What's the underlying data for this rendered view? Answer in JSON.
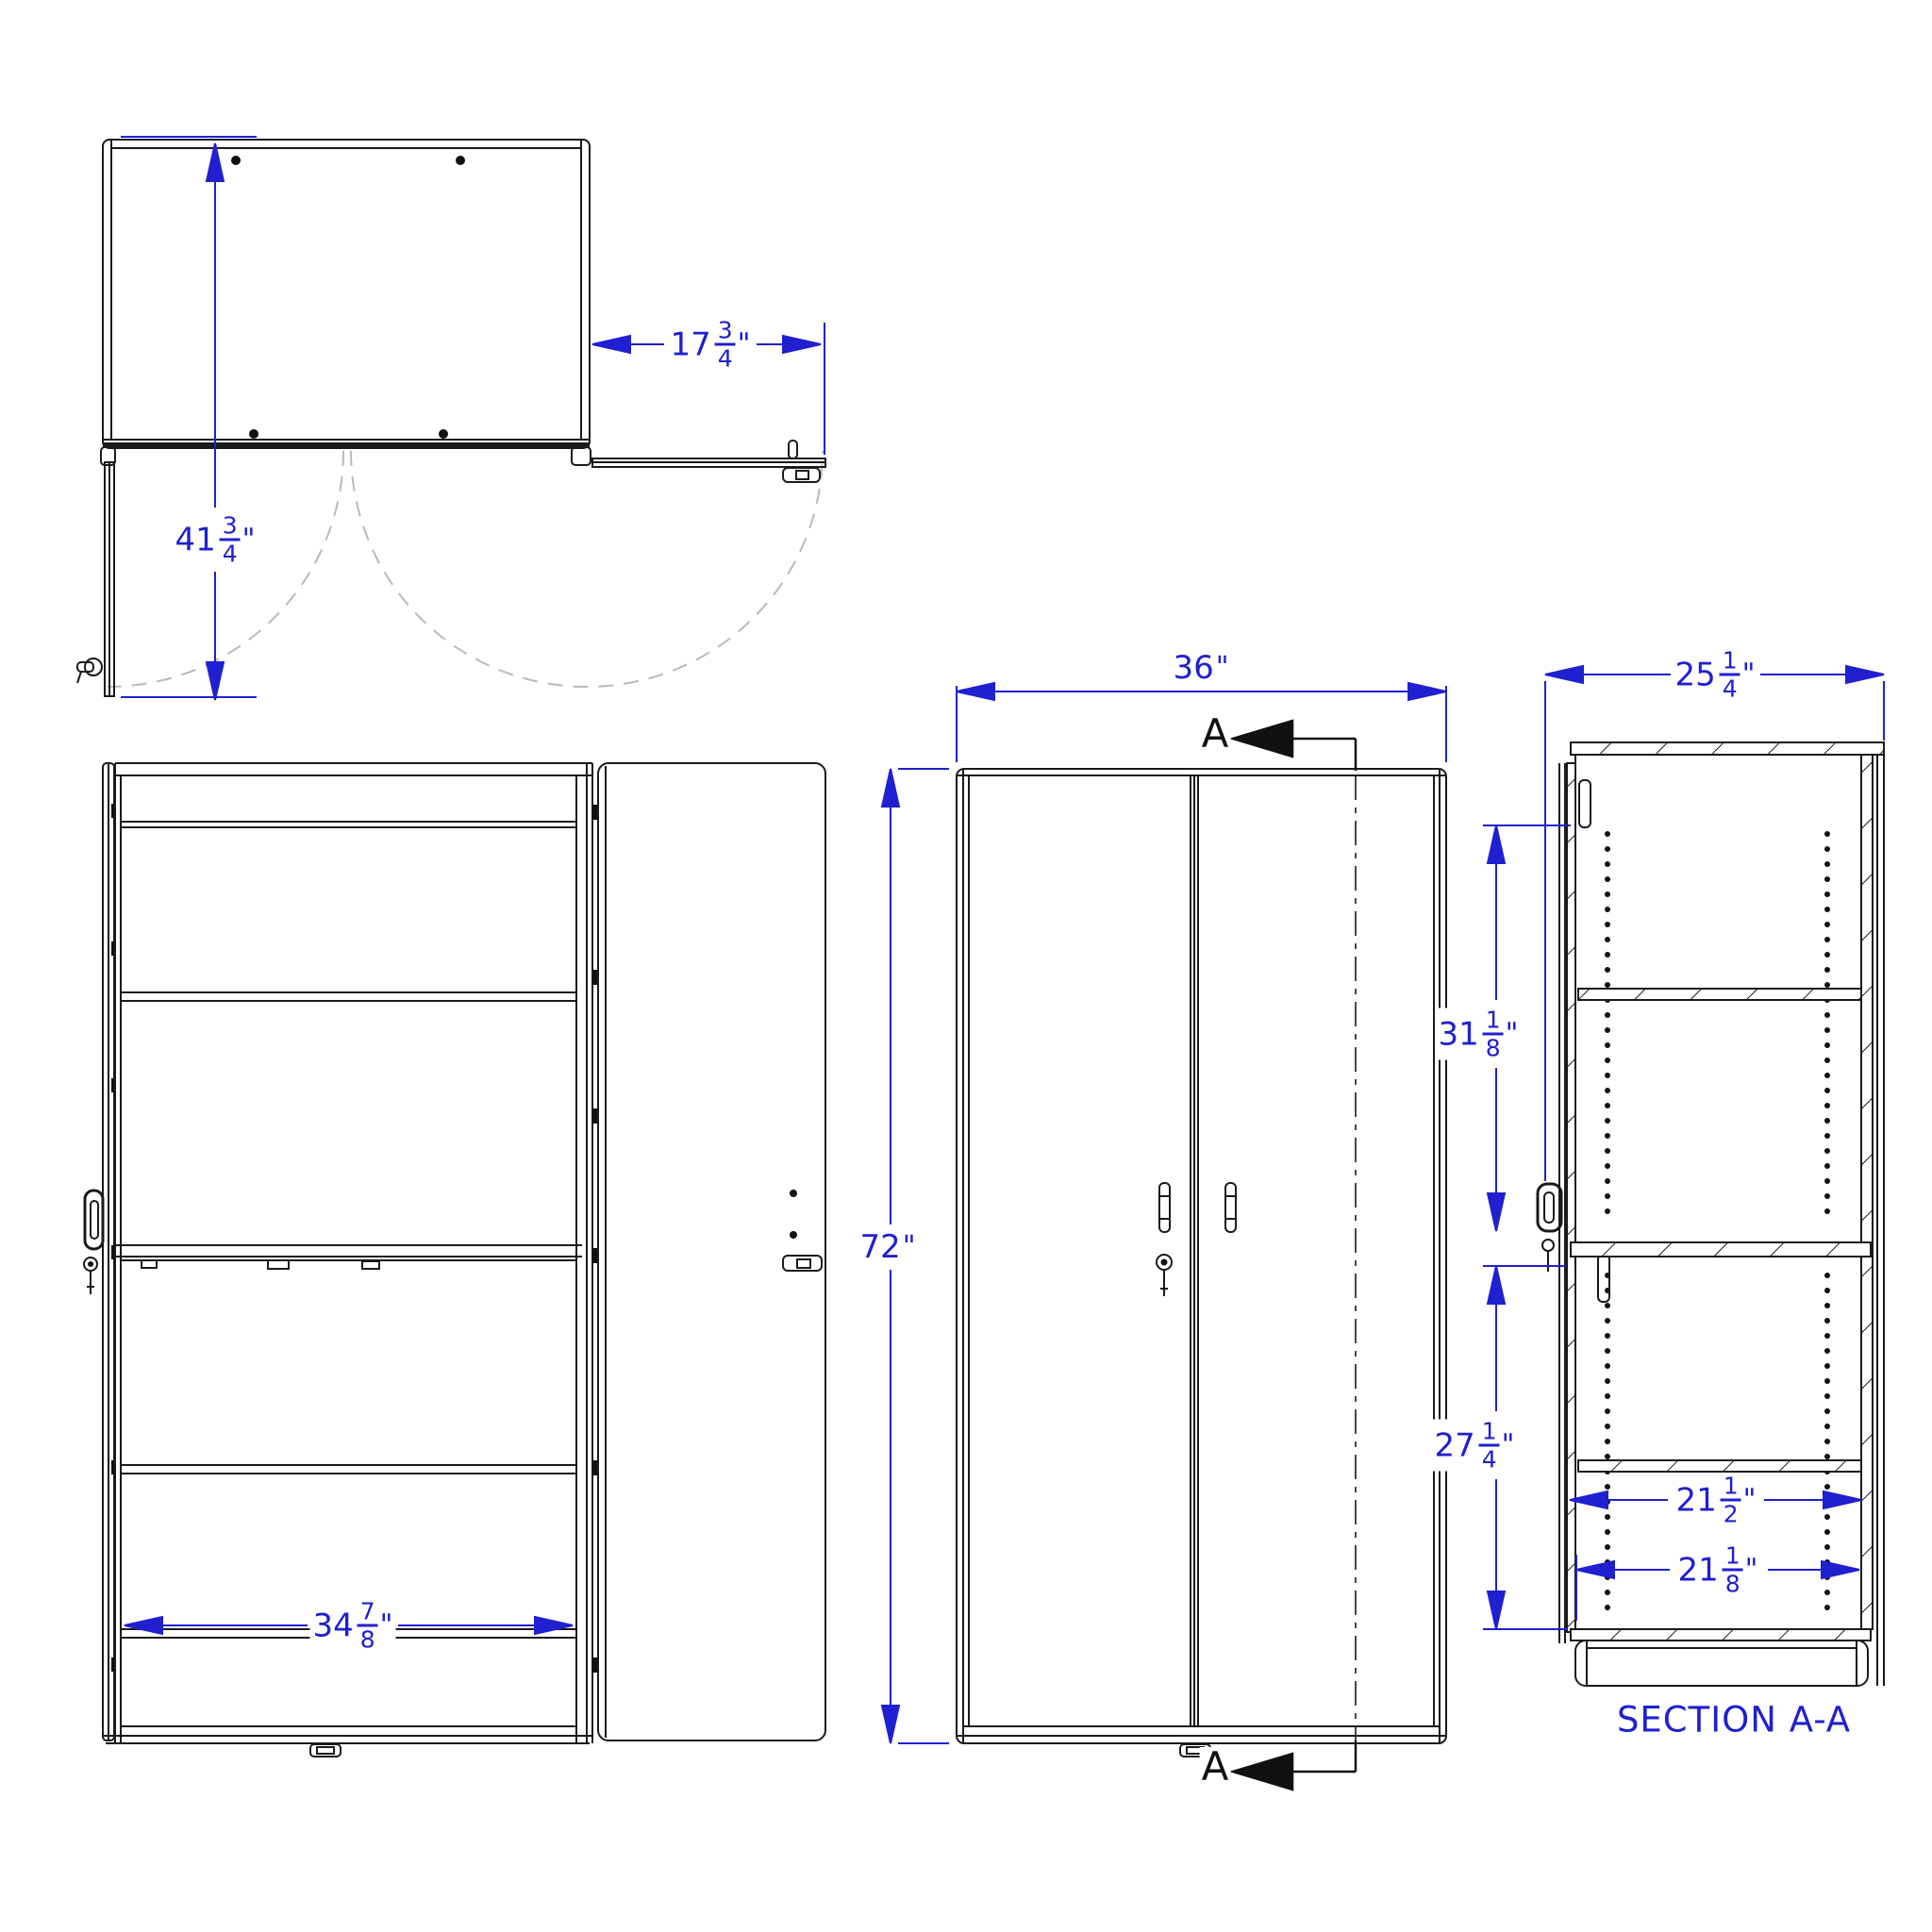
{
  "drawing": {
    "section_title": "SECTION A-A",
    "section_marker": {
      "top": "A",
      "bottom": "A"
    }
  },
  "dimensions": {
    "door_width": {
      "whole": "17",
      "num": "3",
      "den": "4",
      "unit": "\""
    },
    "open_door_depth": {
      "whole": "41",
      "num": "3",
      "den": "4",
      "unit": "\""
    },
    "interior_width": {
      "whole": "34",
      "num": "7",
      "den": "8",
      "unit": "\""
    },
    "overall_width": {
      "whole": "36",
      "unit": "\""
    },
    "overall_height": {
      "whole": "72",
      "unit": "\""
    },
    "overall_depth": {
      "whole": "25",
      "num": "1",
      "den": "4",
      "unit": "\""
    },
    "upper_interior_height": {
      "whole": "31",
      "num": "1",
      "den": "8",
      "unit": "\""
    },
    "lower_interior_height": {
      "whole": "27",
      "num": "1",
      "den": "4",
      "unit": "\""
    },
    "upper_shelf_depth": {
      "whole": "21",
      "num": "1",
      "den": "2",
      "unit": "\""
    },
    "lower_shelf_depth": {
      "whole": "21",
      "num": "1",
      "den": "8",
      "unit": "\""
    }
  },
  "colors": {
    "dimension": "#2020d0",
    "linework": "#1a1a1a",
    "swing_arc": "#b9b9b9"
  }
}
